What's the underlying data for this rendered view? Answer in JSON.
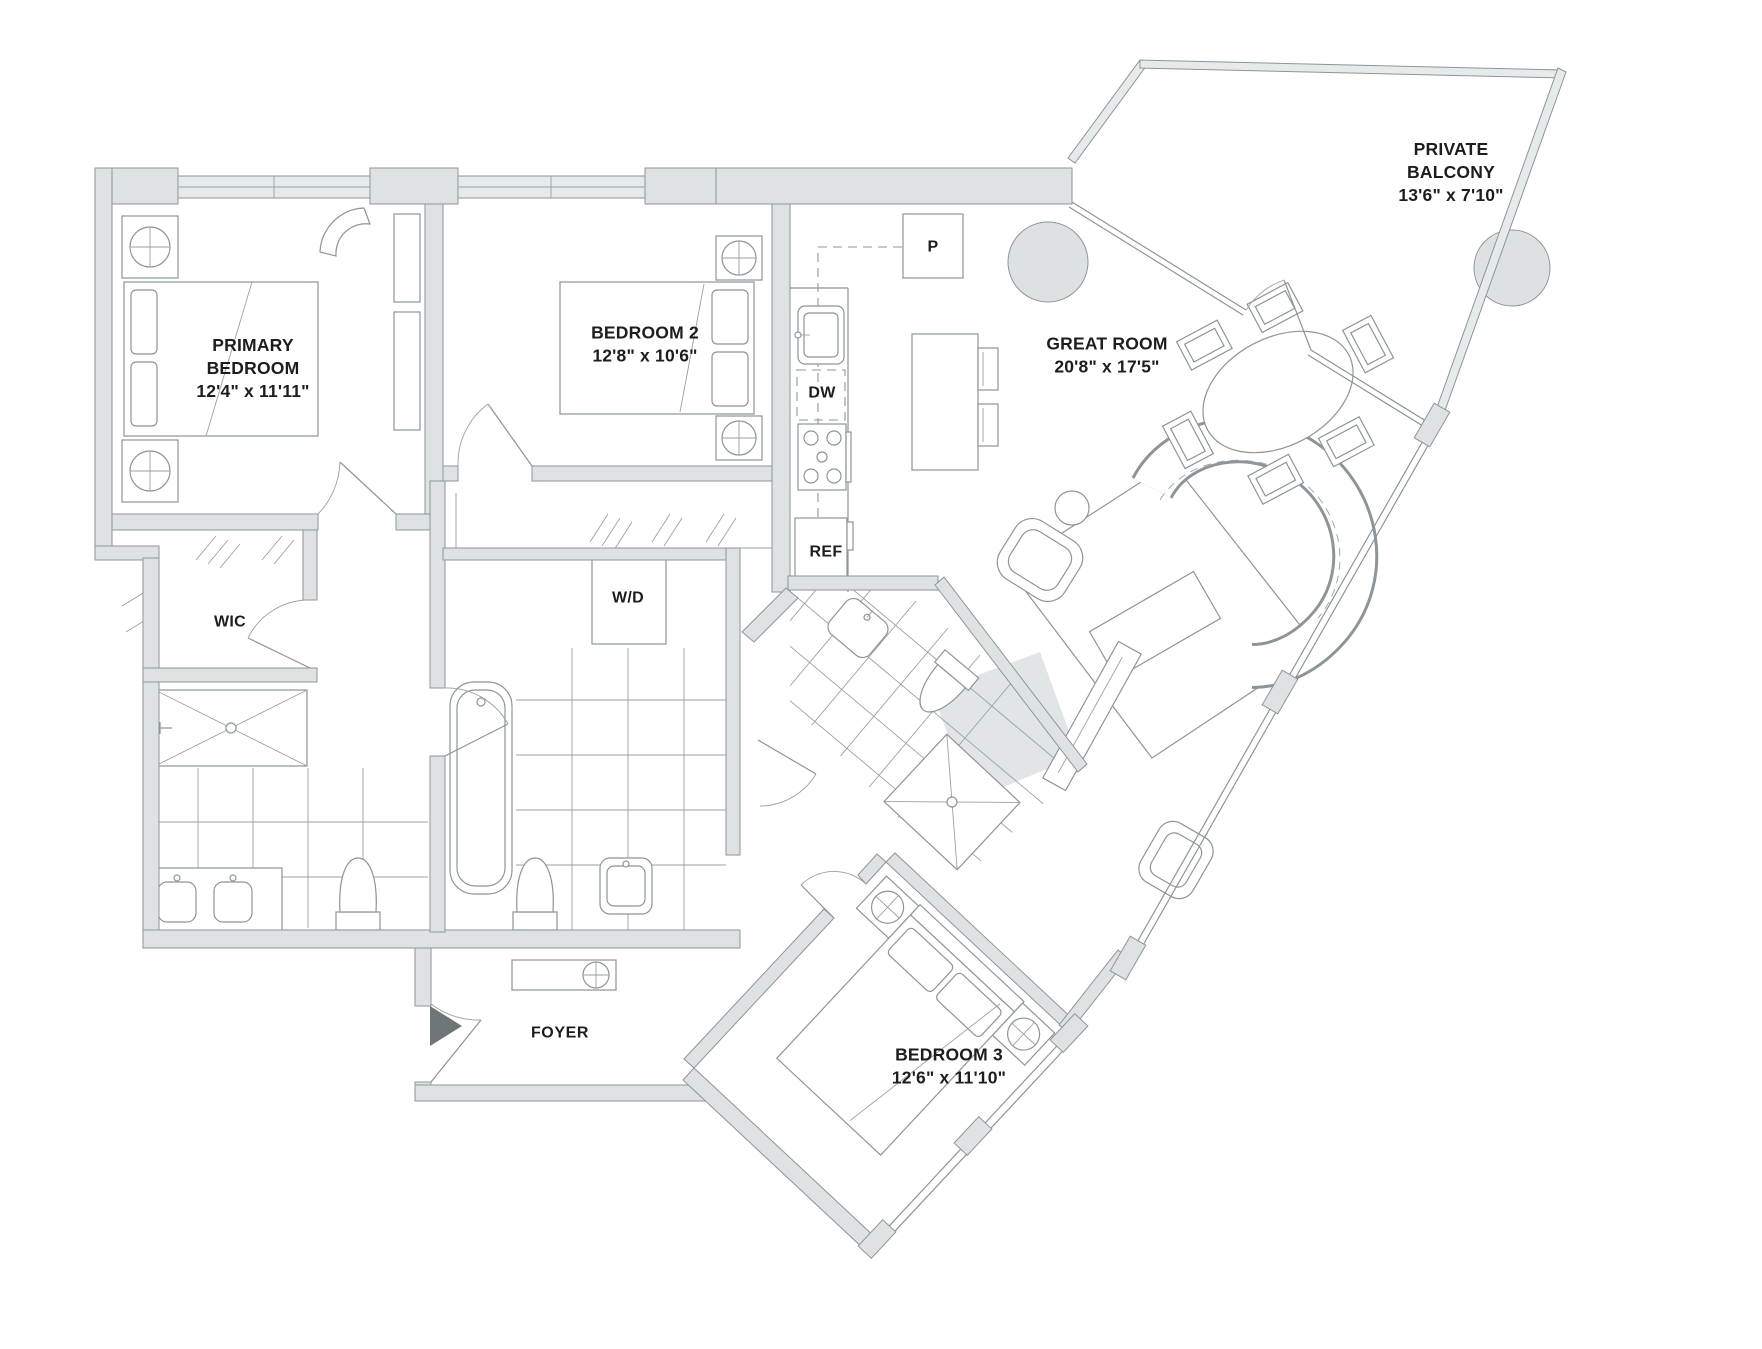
{
  "plan_title": "Residential unit floor plan",
  "rooms": {
    "primary_bedroom": {
      "name": "PRIMARY BEDROOM",
      "dimensions": "12'4\" x 11'11\""
    },
    "bedroom_2": {
      "name": "BEDROOM 2",
      "dimensions": "12'8\" x 10'6\""
    },
    "bedroom_3": {
      "name": "BEDROOM 3",
      "dimensions": "12'6\" x 11'10\""
    },
    "great_room": {
      "name": "GREAT ROOM",
      "dimensions": "20'8\" x 17'5\""
    },
    "private_balcony": {
      "name": "PRIVATE BALCONY",
      "dimensions": "13'6\" x 7'10\""
    },
    "foyer": {
      "name": "FOYER"
    },
    "walk_in_closet": {
      "name": "WIC"
    }
  },
  "fixtures": {
    "washer_dryer": "W/D",
    "dishwasher": "DW",
    "refrigerator": "REF",
    "pantry": "P"
  },
  "colors": {
    "wall_fill": "#dfe2e3",
    "line": "#8d9599",
    "text": "#1d1d1d",
    "entry_arrow": "#6e7579"
  }
}
